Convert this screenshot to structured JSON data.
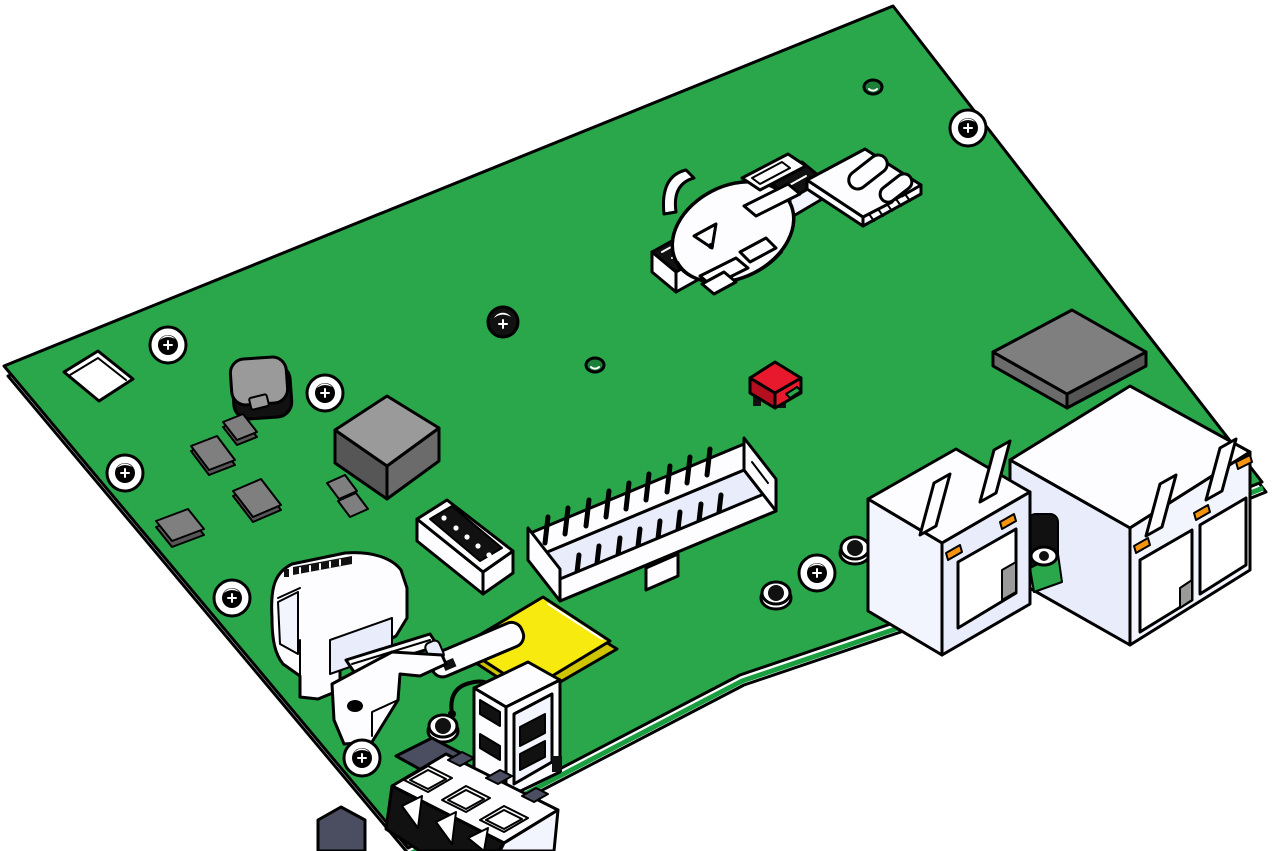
{
  "canvas": {
    "width": 1281,
    "height": 851,
    "background_color": "#ffffff",
    "view": "isometric-cad-render"
  },
  "colors": {
    "ink": "#000000",
    "white": "#ffffff",
    "comp_white": "#fdfdff",
    "board_green": "#2aa74a",
    "board_green_bright": "#1a9e40",
    "board_green_dark": "#0d7a2f",
    "hole_green": "#1c8038",
    "lavender": "#e9ecfa",
    "lavender_soft": "#f3f5fe",
    "gray_light": "#9a9a9a",
    "gray": "#7f7f7f",
    "gray_mid": "#6b6b6b",
    "gray_dark": "#565656",
    "near_black": "#111111",
    "slate": "#4a4e60",
    "red": "#e8192c",
    "red_dark": "#b50e1e",
    "yellow": "#f7ea0e",
    "yellow_dark": "#cfc400",
    "orange": "#f5940f"
  },
  "components": [
    {
      "id": "pcb-board",
      "label": "green printed circuit board"
    },
    {
      "id": "corner-cutout",
      "label": "square cutout near left corner"
    },
    {
      "id": "coin-cell-holder",
      "label": "coin cell battery retainer"
    },
    {
      "id": "sim-card-slot",
      "label": "micro SIM card socket"
    },
    {
      "id": "flat-chip",
      "label": "flat gray IC top right"
    },
    {
      "id": "inductor",
      "label": "dark shielded inductor"
    },
    {
      "id": "smd-chips",
      "label": "small gray SMD components"
    },
    {
      "id": "large-chip",
      "label": "large gray IC cube"
    },
    {
      "id": "red-jumper",
      "label": "red jumper block"
    },
    {
      "id": "idc-box-header",
      "label": "shrouded pin box header"
    },
    {
      "id": "pin-header",
      "label": "small vertical pin header"
    },
    {
      "id": "yellow-ic",
      "label": "yellow square chip"
    },
    {
      "id": "power-module",
      "label": "large white module"
    },
    {
      "id": "metal-bracket",
      "label": "mounting bracket plate"
    },
    {
      "id": "coax-pigtail",
      "label": "white coax pigtail connector"
    },
    {
      "id": "usb-port",
      "label": "vertical USB-A receptacle"
    },
    {
      "id": "terminal-block",
      "label": "3-position terminal block"
    },
    {
      "id": "rj45-single",
      "label": "single RJ45 jack"
    },
    {
      "id": "rj45-dual",
      "label": "dual RJ45 jack"
    },
    {
      "id": "barrel-connector",
      "label": "round panel connector between jacks"
    },
    {
      "id": "mounting-screws",
      "label": "mounting screws",
      "count": 7
    },
    {
      "id": "standoff-caps",
      "label": "round standoff caps",
      "count": 4
    },
    {
      "id": "tooling-holes",
      "label": "small tooling holes",
      "count": 2
    }
  ]
}
